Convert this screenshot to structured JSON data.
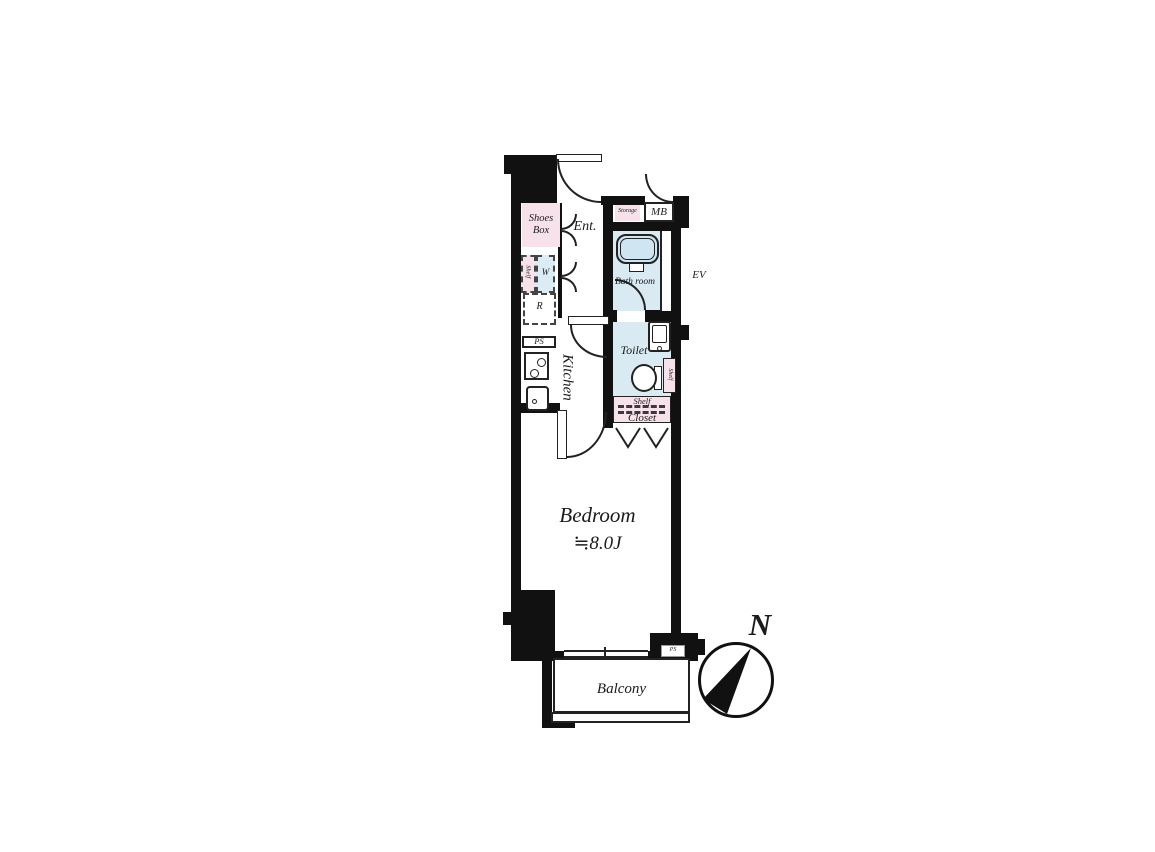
{
  "title": "Apartment floor plan",
  "labels": {
    "shoes_box": "Shoes Box",
    "entrance": "Ent.",
    "storage": "Storage",
    "meter_box": "MB",
    "bath_room": "Bath room",
    "elevator": "EV",
    "shelf_left": "Shelf",
    "washer": "W",
    "refrigerator": "R",
    "pipe_space": "PS",
    "kitchen": "Kitchen",
    "toilet": "Toilet",
    "toilet_shelf": "Shelf",
    "closet_shelf": "Shelf",
    "closet": "Closet",
    "bedroom": "Bedroom",
    "bedroom_size": "≒8.0J",
    "balcony": "Balcony",
    "pipe_space_small": "PS",
    "north": "N"
  },
  "colors": {
    "wall": "#111111",
    "wet_area_fill": "#d9eaf3",
    "tub_fill": "#cfe5f1",
    "furniture_pink": "#f7e2eb",
    "washer_blue": "#dcecf5",
    "line": "#222222"
  }
}
